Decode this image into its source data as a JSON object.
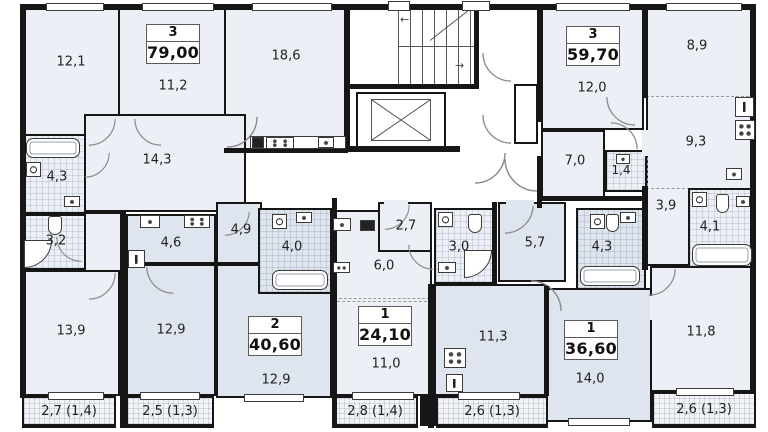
{
  "apartments": [
    {
      "rooms_count": "3",
      "total_area": "79,00"
    },
    {
      "rooms_count": "3",
      "total_area": "59,70"
    },
    {
      "rooms_count": "2",
      "total_area": "40,60"
    },
    {
      "rooms_count": "1",
      "total_area": "24,10"
    },
    {
      "rooms_count": "1",
      "total_area": "36,60"
    }
  ],
  "rooms": {
    "r12_1": "12,1",
    "r11_2": "11,2",
    "r18_6": "18,6",
    "r14_3": "14,3",
    "r4_3a": "4,3",
    "r3_2": "3,2",
    "r13_9": "13,9",
    "r12_0": "12,0",
    "r8_9": "8,9",
    "r9_3": "9,3",
    "r7_0": "7,0",
    "r1_4": "1,4",
    "r3_9": "3,9",
    "r4_1": "4,1",
    "r11_8": "11,8",
    "r4_6": "4,6",
    "r4_9": "4,9",
    "r12_9a": "12,9",
    "r12_9b": "12,9",
    "r4_0": "4,0",
    "r2_7": "2,7",
    "r6_0": "6,0",
    "r3_0": "3,0",
    "r11_0": "11,0",
    "r5_7": "5,7",
    "r4_3b": "4,3",
    "r11_3": "11,3",
    "r14_0": "14,0"
  },
  "balconies": [
    "2,7 (1,4)",
    "2,5 (1,3)",
    "2,8 (1,4)",
    "2,6 (1,3)",
    "2,6 (1,3)"
  ],
  "colors": {
    "wall": "#161616",
    "room_light": "#ecf0f6",
    "room_dark": "#dfe5ee"
  }
}
